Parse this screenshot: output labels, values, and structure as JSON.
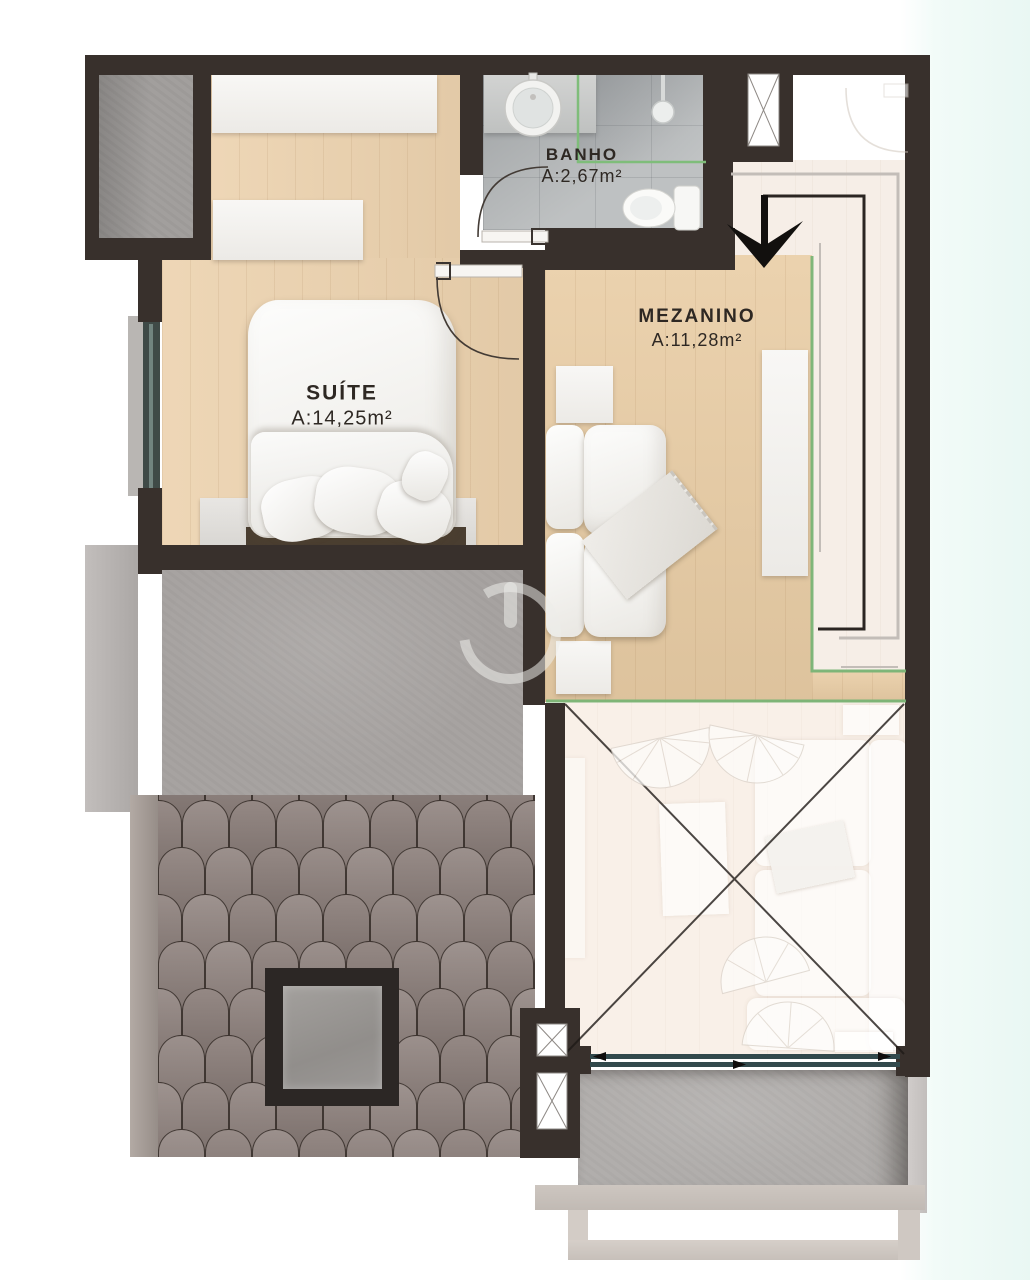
{
  "plan": {
    "type": "floor-plan",
    "level": "mezzanine-level"
  },
  "rooms": [
    {
      "id": "banho",
      "name": "BANHO",
      "area": "A:2,67m²"
    },
    {
      "id": "suite",
      "name": "SUÍTE",
      "area": "A:14,25m²"
    },
    {
      "id": "mezanino",
      "name": "MEZANINO",
      "area": "A:11,28m²"
    }
  ],
  "icons": {
    "watermark": "power-icon",
    "entry_arrow": "entry-arrow-down",
    "void_marker": "x-cross",
    "shaft_marker": "x-panel"
  },
  "colors": {
    "wall": "#38302c",
    "wood_floor": "#ecd2ae",
    "bath_tile": "#b7babb",
    "concrete": "#a7a3a1",
    "shingle_roof": "#857c78",
    "glass_railing_green": "#7ab677",
    "void_floor": "#f9f0e8",
    "label_text": "#2e2823",
    "background_tint": "#e9f7f3"
  }
}
